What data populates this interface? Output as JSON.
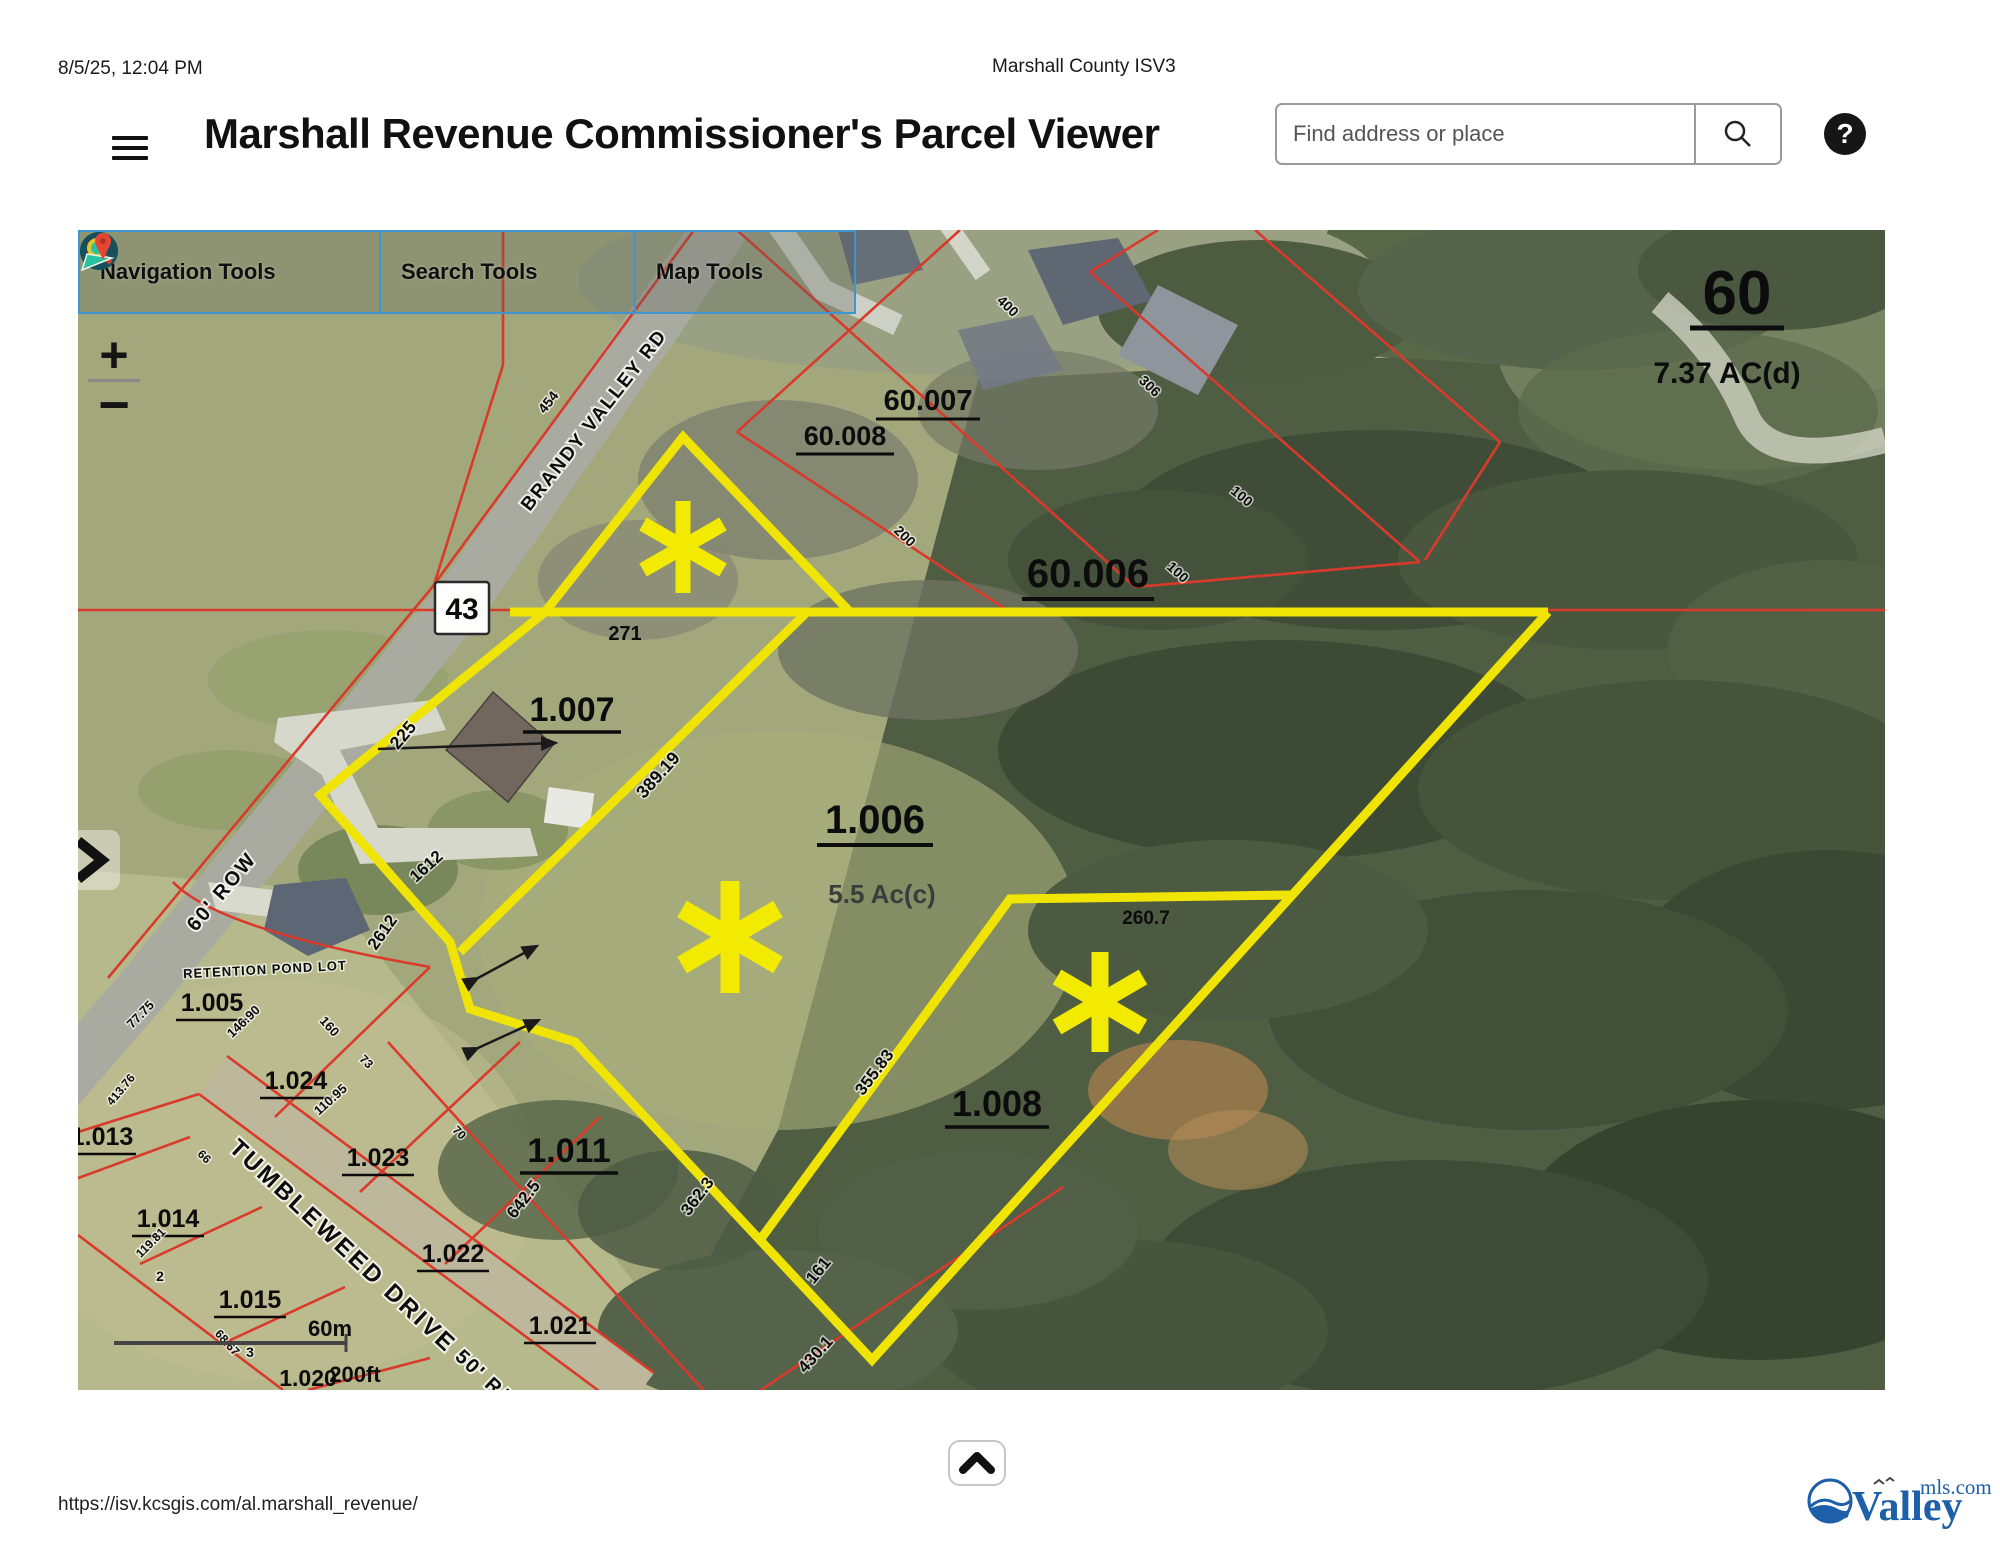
{
  "meta": {
    "datetime": "8/5/25, 12:04 PM",
    "doc_title": "Marshall County ISV3"
  },
  "header": {
    "title": "Marshall Revenue Commissioner's Parcel Viewer",
    "search_placeholder": "Find address or place",
    "help_label": "?"
  },
  "toolbar": {
    "navigation_label": "Navigation Tools",
    "search_label": "Search Tools",
    "map_label": "Map Tools"
  },
  "map_controls": {
    "zoom_in": "+",
    "zoom_out": "−"
  },
  "map": {
    "highway_shield": "43",
    "scale": {
      "metric": "60m",
      "imperial": "200ft"
    },
    "labels": {
      "p60": "60",
      "ac737": "7.37 AC(d)",
      "p60007": "60.007",
      "p60008": "60.008",
      "p60006": "60.006",
      "p1007": "1.007",
      "p1006": "1.006",
      "acres55": "5.5 Ac(c)",
      "p1008": "1.008",
      "p1011": "1.011",
      "p1005": "1.005",
      "p1024": "1.024",
      "p1023": "1.023",
      "p1013": "1.013",
      "p1014": "1.014",
      "p1015": "1.015",
      "p1022": "1.022",
      "p1021": "1.021",
      "p1020": "1.020",
      "d271": "271",
      "d38919": "389.19",
      "d225": "225",
      "d1612": "1612",
      "d2612": "2612",
      "d2607": "260.7",
      "d35583": "355.83",
      "d3623": "362.3",
      "d161": "161",
      "d4301": "430.1",
      "d6425": "642.5",
      "d454": "454",
      "d400": "400",
      "d306": "306",
      "d200": "200",
      "d100a": "100",
      "d100b": "100",
      "d7775": "77.75",
      "d14690": "146.90",
      "d160": "160",
      "d11095": "110.95",
      "d73": "73",
      "d70": "70",
      "d66": "66",
      "d41376": "413.76",
      "d11981": "119.81",
      "d6867": "68.67",
      "lot2": "2",
      "lot3": "3",
      "retention": "RETENTION POND LOT",
      "tumbleweed": "TUMBLEWEED DRIVE",
      "row50": "50' R/W",
      "row60": "60' ROW",
      "brandy": "BRANDY VALLEY RD"
    }
  },
  "footer": {
    "url": "https://isv.kcsgis.com/al.marshall_revenue/",
    "logo_valley": "Valley",
    "logo_mls": "mls.com"
  }
}
